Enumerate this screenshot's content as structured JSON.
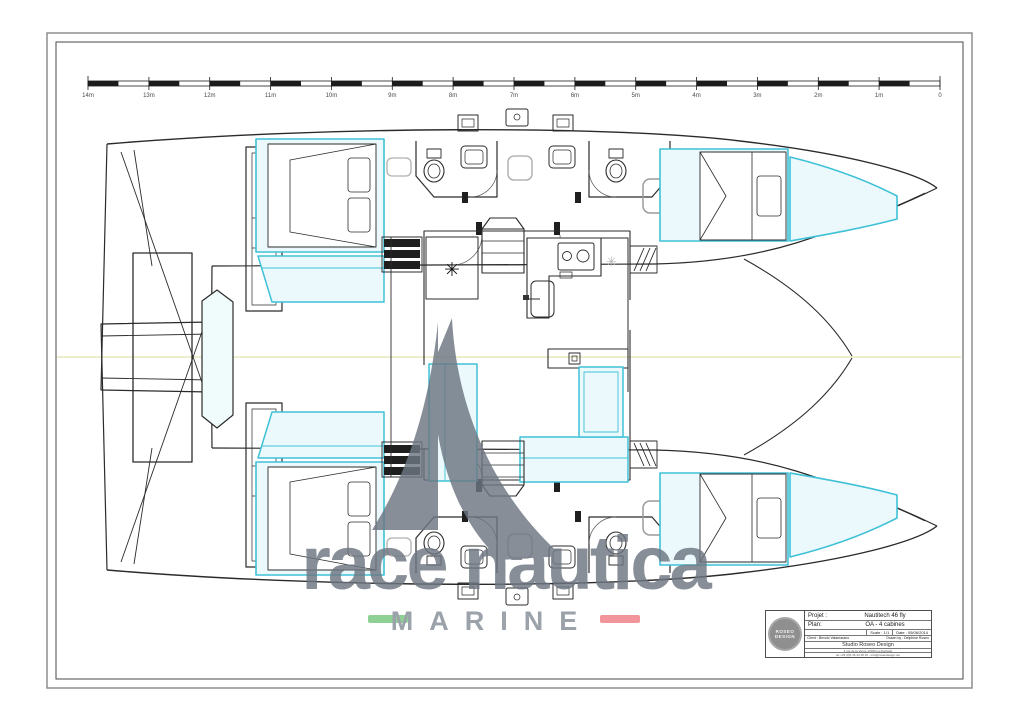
{
  "scale_bar": {
    "unit_labels": [
      "14m",
      "13m",
      "12m",
      "11m",
      "10m",
      "9m",
      "8m",
      "7m",
      "6m",
      "5m",
      "4m",
      "3m",
      "2m",
      "1m",
      "0"
    ]
  },
  "watermark": {
    "brand": "race nautica",
    "subtitle": "MARINE",
    "text_color": "#6d7681",
    "accent_green": "#77c67d",
    "accent_red": "#ee7e86"
  },
  "icons": {
    "snowflake_glyph": "✳"
  },
  "plan_colors": {
    "line": "#2b2b2b",
    "highlight": "#3fc1d6",
    "highlight_fill": "#ebf9fc",
    "centerline": "#e9e9bc"
  },
  "title_block": {
    "project_label": "Projet :",
    "project_value": "Nautitech 46 fly",
    "plan_label": "Plan:",
    "plan_value": "OA - 4 cabines",
    "scale_text": "Scale : 1/1",
    "date_text": "Date : 05/06/2014",
    "client_text": "Client : Bevolo Valamarano",
    "drawn_by_text": "Drawn by : Delphine Roseo",
    "studio": "Studio Roseo Design",
    "address": "4 rue de la Verne 17000 La Rochelle",
    "contact": "tel +33 (0)5 46 44 18 10 - info@roseodesign.net",
    "logo_line1": "ROSEO",
    "logo_line2": "DESIGN"
  }
}
